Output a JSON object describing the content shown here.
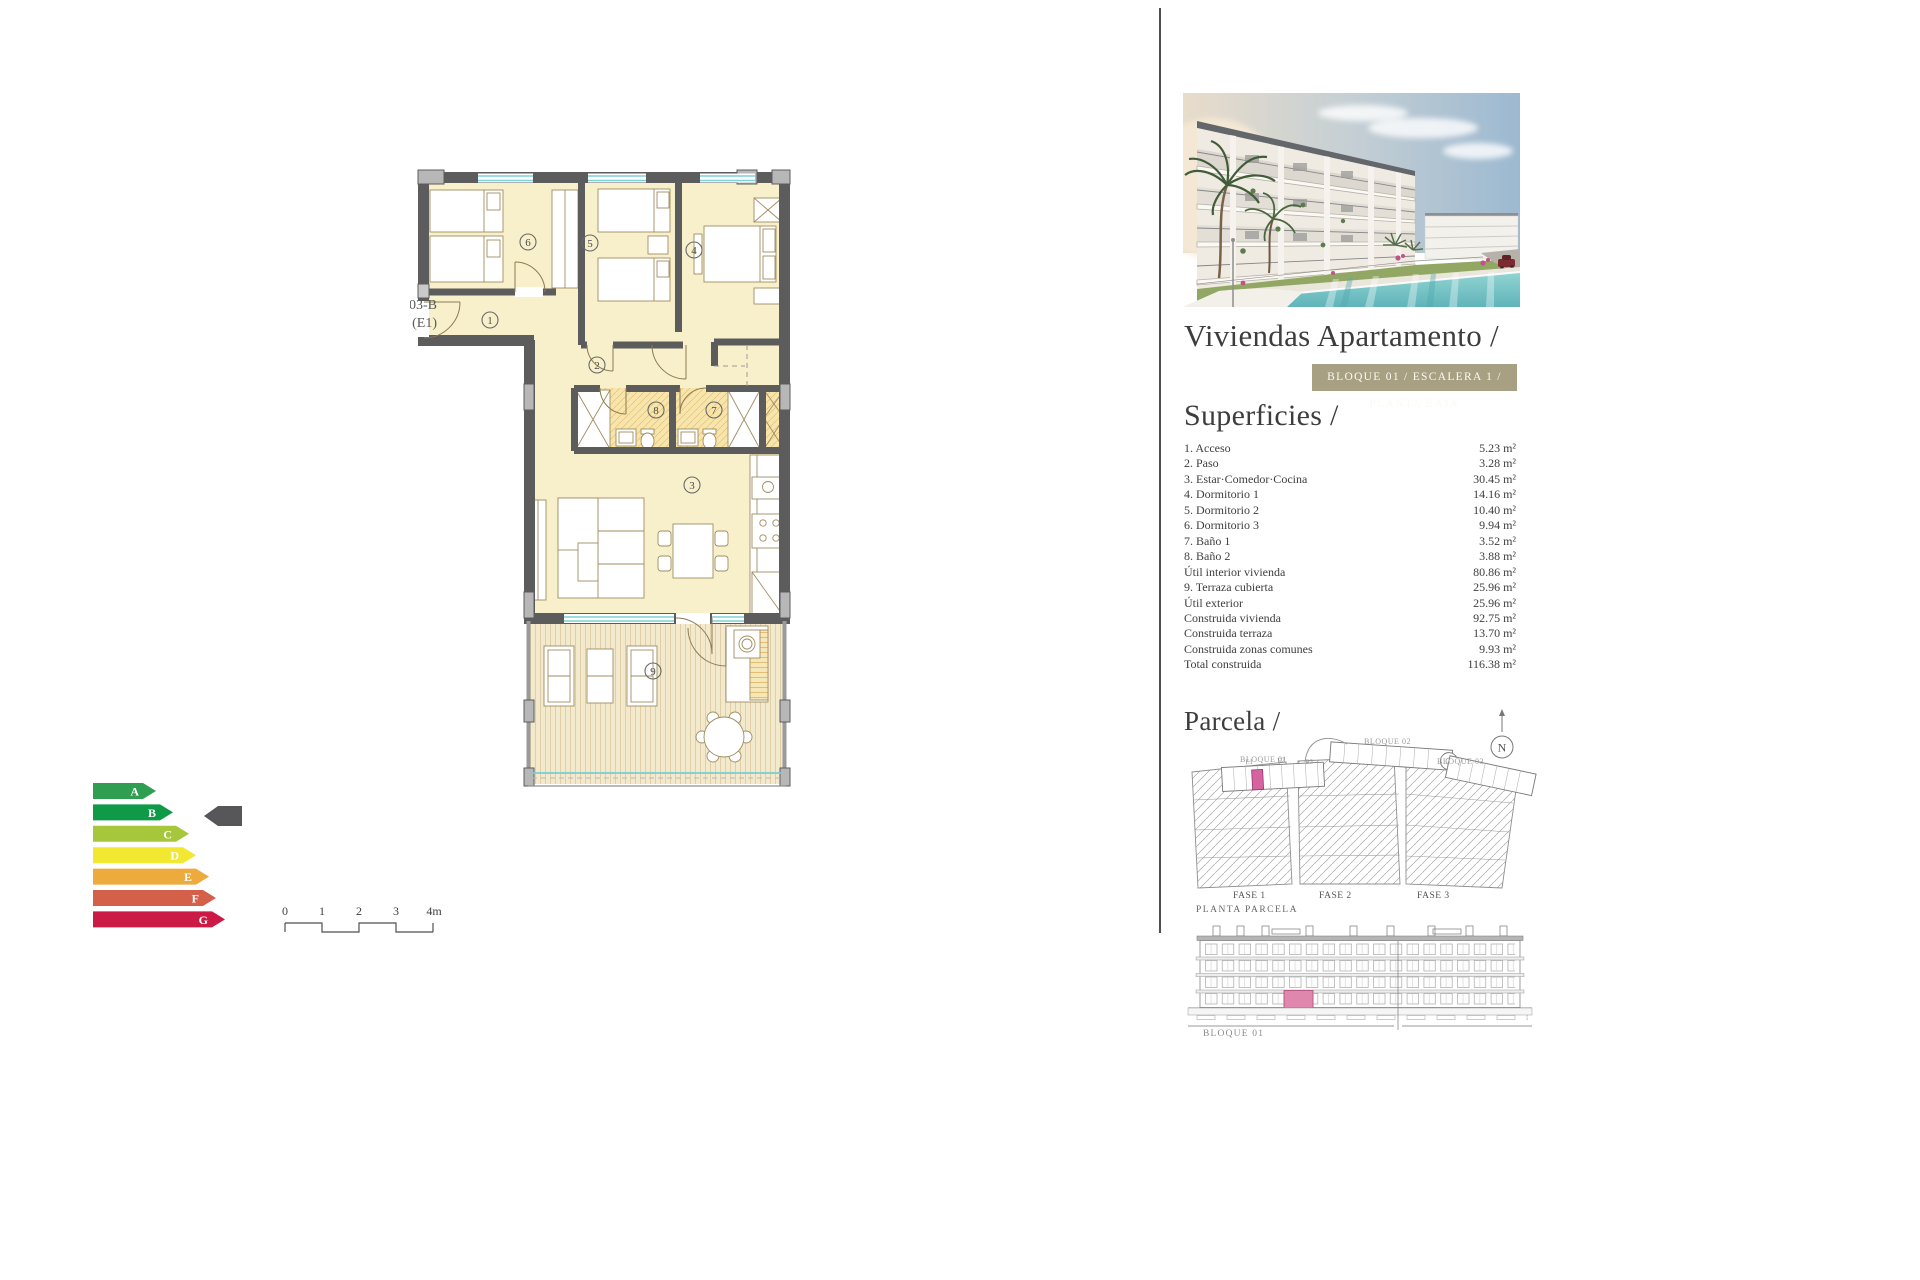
{
  "header": {
    "title": "Viviendas Apartamento /",
    "badge": "BLOQUE 01 / ESCALERA 1 / PLANTA BAJA",
    "badge_bg": "#a7a083"
  },
  "superficies": {
    "heading": "Superficies /",
    "items": [
      {
        "label": "1. Acceso",
        "value": "5.23 m²"
      },
      {
        "label": "2. Paso",
        "value": "3.28 m²"
      },
      {
        "label": "3. Estar·Comedor·Cocina",
        "value": "30.45 m²"
      },
      {
        "label": "4. Dormitorio 1",
        "value": "14.16 m²"
      },
      {
        "label": "5. Dormitorio 2",
        "value": "10.40 m²"
      },
      {
        "label": "6. Dormitorio 3",
        "value": "9.94 m²"
      },
      {
        "label": "7. Baño 1",
        "value": "3.52 m²"
      },
      {
        "label": "8. Baño 2",
        "value": "3.88 m²"
      },
      {
        "label": "Útil interior vivienda",
        "value": "80.86 m²"
      },
      {
        "label": "9. Terraza cubierta",
        "value": "25.96 m²"
      },
      {
        "label": "Útil exterior",
        "value": "25.96 m²"
      },
      {
        "label": "Construida vivienda",
        "value": "92.75 m²"
      },
      {
        "label": "Construida terraza",
        "value": "13.70 m²"
      },
      {
        "label": "Construida zonas comunes",
        "value": "9.93 m²"
      },
      {
        "label": "Total construida",
        "value": "116.38 m²"
      }
    ]
  },
  "parcela": {
    "heading": "Parcela /",
    "compass_label": "N",
    "bloque_labels": [
      "BLOQUE 01",
      "BLOQUE 02",
      "BLOQUE 03"
    ],
    "escalera_labels": [
      "E1",
      "E2",
      "E3"
    ],
    "fase_labels": [
      "FASE 1",
      "FASE 2",
      "FASE 3"
    ],
    "caption": "PLANTA PARCELA",
    "highlight_color": "#d5639f"
  },
  "elevation": {
    "caption": "BLOQUE 01",
    "highlight_color": "#e087ad"
  },
  "floorplan": {
    "unit_code": "AP-03-B",
    "unit_stair": "(E1)",
    "room_numbers": [
      "1",
      "2",
      "3",
      "4",
      "5",
      "6",
      "7",
      "8",
      "9"
    ]
  },
  "energy_label": {
    "levels": [
      {
        "letter": "A",
        "color": "#2f9e50"
      },
      {
        "letter": "B",
        "color": "#0f9a48"
      },
      {
        "letter": "C",
        "color": "#a6c73c"
      },
      {
        "letter": "D",
        "color": "#f2e832"
      },
      {
        "letter": "E",
        "color": "#edaa3d"
      },
      {
        "letter": "F",
        "color": "#d5604a"
      },
      {
        "letter": "G",
        "color": "#cb1a45"
      }
    ],
    "indicator_color": "#57575a"
  },
  "scalebar": {
    "ticks": [
      "0",
      "1",
      "2",
      "3",
      "4m"
    ]
  }
}
